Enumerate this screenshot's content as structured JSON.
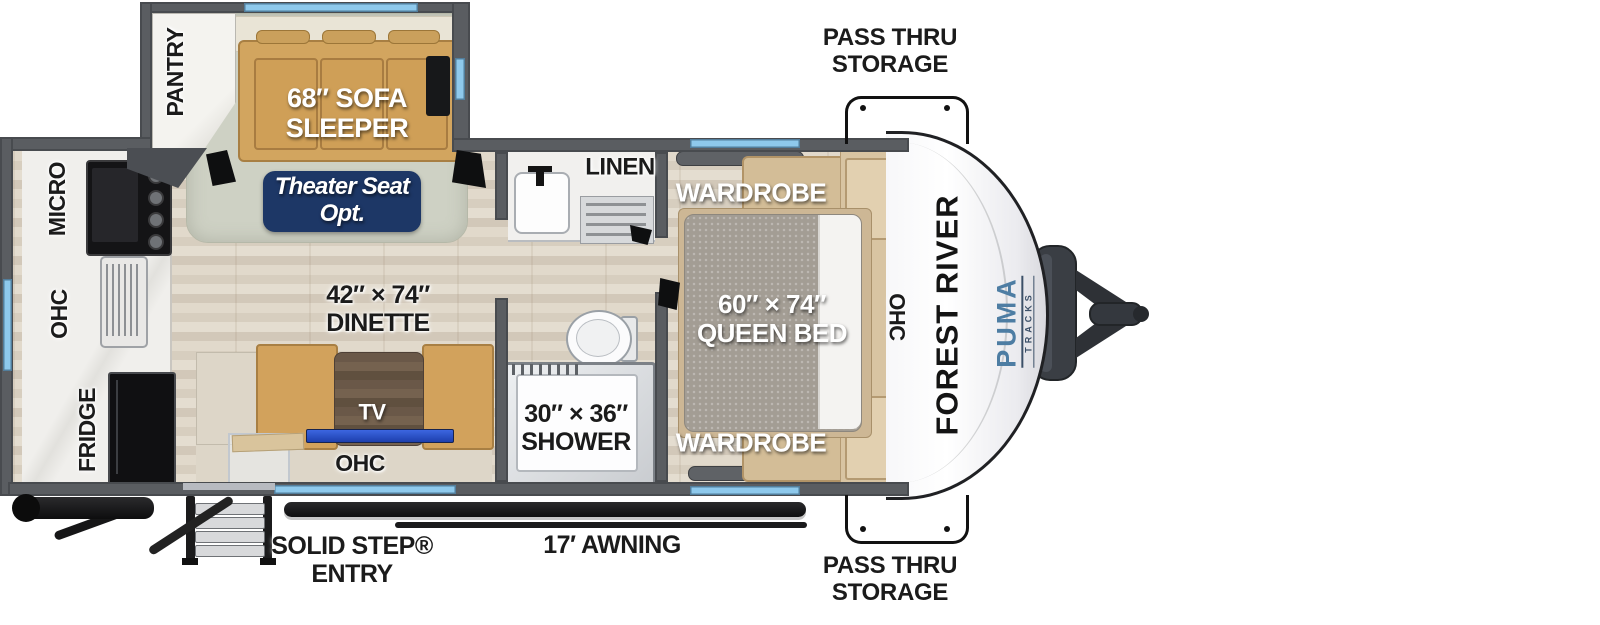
{
  "colors": {
    "wall_gray": "#5a5d61",
    "window_blue": "#8ec9ec",
    "badge_navy": "#1d3766",
    "puma_blue": "#4d7da3",
    "tv_blue": "#2b55c8",
    "cabinet_tan": "#d2a55f",
    "carpet": "#ced1c4",
    "floor_wood": "#dcd4c6"
  },
  "kitchen": {
    "micro": "MICRO",
    "ohc": "OHC",
    "fridge": "FRIDGE"
  },
  "living": {
    "pantry": "PANTRY",
    "sofa": {
      "line1": "68″ SOFA",
      "line2": "SLEEPER"
    },
    "theater": {
      "line1": "Theater Seat",
      "line2": "Opt."
    },
    "dinette": {
      "line1": "42″ × 74″",
      "line2": "DINETTE"
    },
    "tv": "TV",
    "ohc": "OHC"
  },
  "bath": {
    "linen": "LINEN",
    "shower": {
      "line1": "30″ × 36″",
      "line2": "SHOWER"
    }
  },
  "bedroom": {
    "wardrobe_top": "WARDROBE",
    "wardrobe_bottom": "WARDROBE",
    "bed": {
      "line1": "60″ × 74″",
      "line2": "QUEEN BED"
    },
    "ohc": "OHC"
  },
  "exterior": {
    "brand": "FOREST RIVER",
    "model": "PUMA",
    "model_sub": "TRACKS",
    "pass_thru_top": {
      "line1": "PASS THRU",
      "line2": "STORAGE"
    },
    "pass_thru_bottom": {
      "line1": "PASS THRU",
      "line2": "STORAGE"
    },
    "entry": {
      "line1": "SOLID STEP®",
      "line2": "ENTRY"
    },
    "awning": "17′ AWNING"
  }
}
